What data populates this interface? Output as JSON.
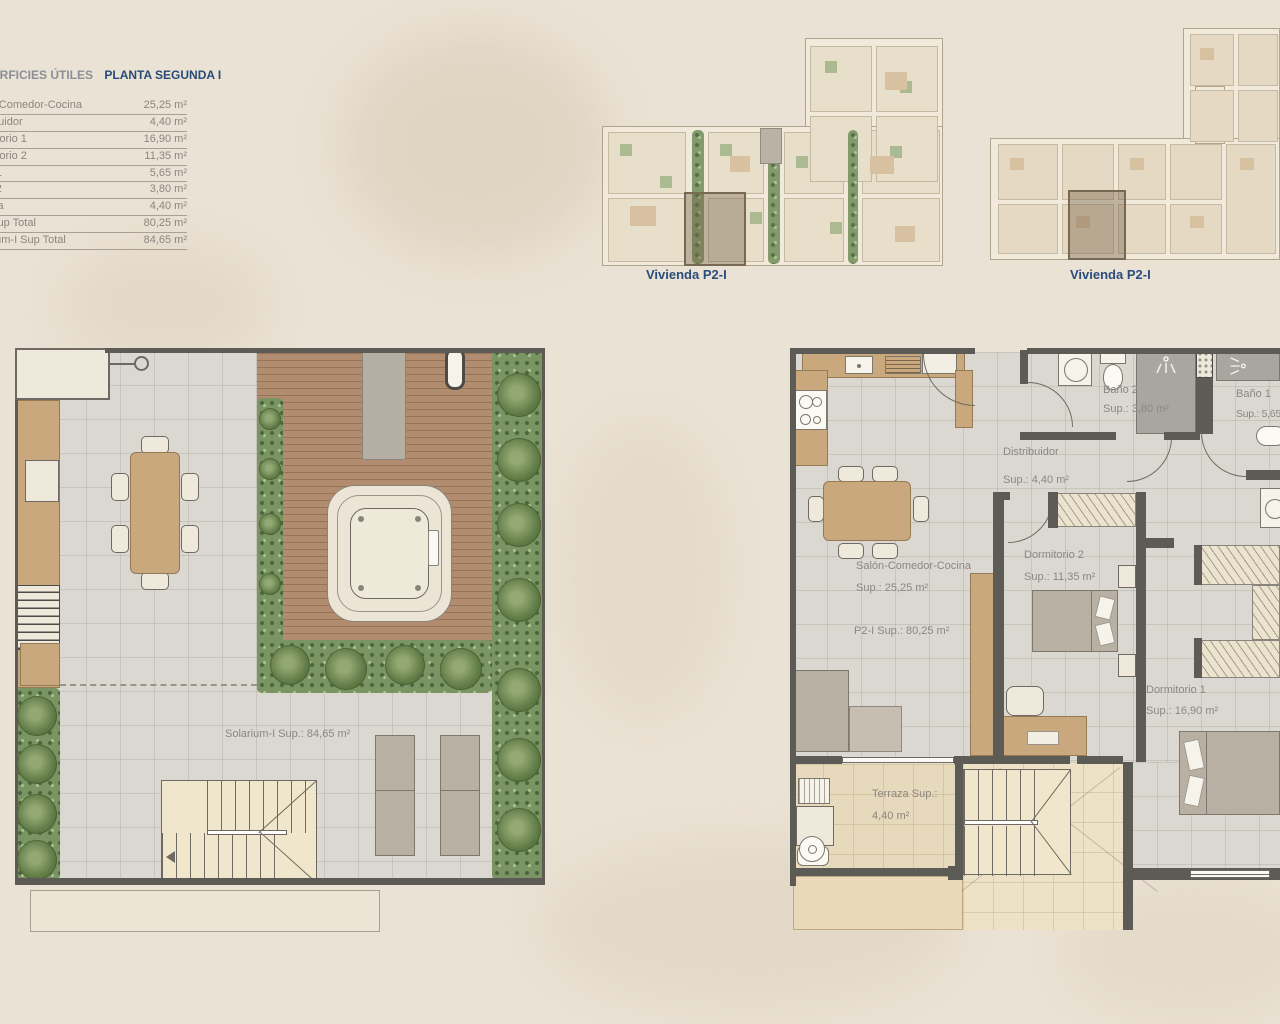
{
  "page": {
    "background_color": "#eae2d4"
  },
  "surface_table": {
    "title": "SUPERFICIES ÚTILES",
    "subtitle": "PLANTA SEGUNDA I",
    "rows": [
      {
        "label": "Salón-Comedor-Cocina",
        "value": "25,25 m²"
      },
      {
        "label": "Distribuidor",
        "value": "4,40 m²"
      },
      {
        "label": "Dormitorio 1",
        "value": "16,90 m²"
      },
      {
        "label": "Dormitorio 2",
        "value": "11,35 m²"
      },
      {
        "label": "Baño 1",
        "value": "5,65 m²"
      },
      {
        "label": "Baño 2",
        "value": "3,80 m²"
      },
      {
        "label": "Terraza",
        "value": "4,40 m²"
      },
      {
        "label": "P2-I Sup Total",
        "value": "80,25 m²"
      },
      {
        "label": "Solarium-I Sup Total",
        "value": "84,65 m²"
      }
    ]
  },
  "overview": {
    "plan_a_caption": "Vivienda P2-I",
    "plan_b_caption": "Vivienda P2-I"
  },
  "solarium_plan": {
    "area_label": "Solarium-I Sup.: 84,65 m²"
  },
  "apartment_plan": {
    "bano2_name": "Baño 2",
    "bano2_sup": "Sup.: 3,80 m²",
    "bano1_name": "Baño 1",
    "bano1_sup": "Sup.: 5,65 m²",
    "distribuidor_name": "Distribuidor",
    "distribuidor_sup": "Sup.: 4,40 m²",
    "salon_name": "Salón-Comedor-Cocina",
    "salon_sup": "Sup.: 25,25 m²",
    "total_sup": "P2-I Sup.: 80,25 m²",
    "dorm2_name": "Dormitorio 2",
    "dorm2_sup": "Sup.: 11,35 m²",
    "dorm1_name": "Dormitorio 1",
    "dorm1_sup": "Sup.: 16,90 m²",
    "terraza_name": "Terraza Sup.:",
    "terraza_sup": "4,40 m²"
  },
  "colors": {
    "background": "#eae2d4",
    "caption_navy": "#2b4d7d",
    "label_gray": "#8b8681",
    "wall_gray": "#5d5b56",
    "deck_wood": "#b28c6e",
    "furniture_wood": "#c9a87d",
    "hedge_green": "#7b9463",
    "tile_floor": "#dbd8d2",
    "terrace_tan": "#e7d9bb"
  }
}
